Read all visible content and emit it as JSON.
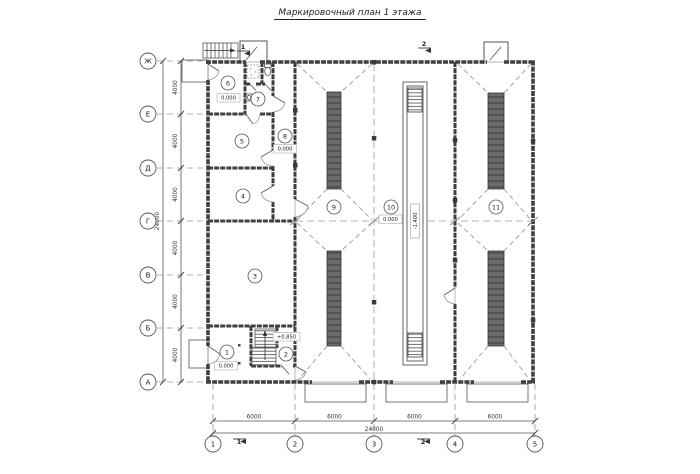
{
  "title": "Маркировочный план 1 этажа",
  "axes": {
    "rows": [
      {
        "label": "Ж"
      },
      {
        "label": "Е"
      },
      {
        "label": "Д"
      },
      {
        "label": "Г"
      },
      {
        "label": "В"
      },
      {
        "label": "Б"
      },
      {
        "label": "А"
      }
    ],
    "cols": [
      {
        "label": "1"
      },
      {
        "label": "2"
      },
      {
        "label": "3"
      },
      {
        "label": "4"
      },
      {
        "label": "5"
      }
    ]
  },
  "dims": {
    "left": {
      "segments": [
        "4000",
        "4000",
        "4000",
        "4000",
        "4000",
        "4000"
      ],
      "total": "24000"
    },
    "bottom": {
      "segments": [
        "6000",
        "6000",
        "6000",
        "6000"
      ],
      "total": "24000"
    }
  },
  "rooms": [
    {
      "num": "1"
    },
    {
      "num": "2"
    },
    {
      "num": "3"
    },
    {
      "num": "4"
    },
    {
      "num": "5"
    },
    {
      "num": "6"
    },
    {
      "num": "7"
    },
    {
      "num": "8"
    },
    {
      "num": "9"
    },
    {
      "num": "10"
    },
    {
      "num": "11"
    }
  ],
  "elevations": {
    "zero": "0.000",
    "stair_landing": "+0.850",
    "pit": "-1.400"
  },
  "sections": {
    "s1": "1",
    "s2": "2"
  },
  "colors": {
    "wall": "#3f3f3f",
    "thin": "#666666",
    "dash": "#9a9a9a",
    "strip": "#6b6b6b"
  }
}
